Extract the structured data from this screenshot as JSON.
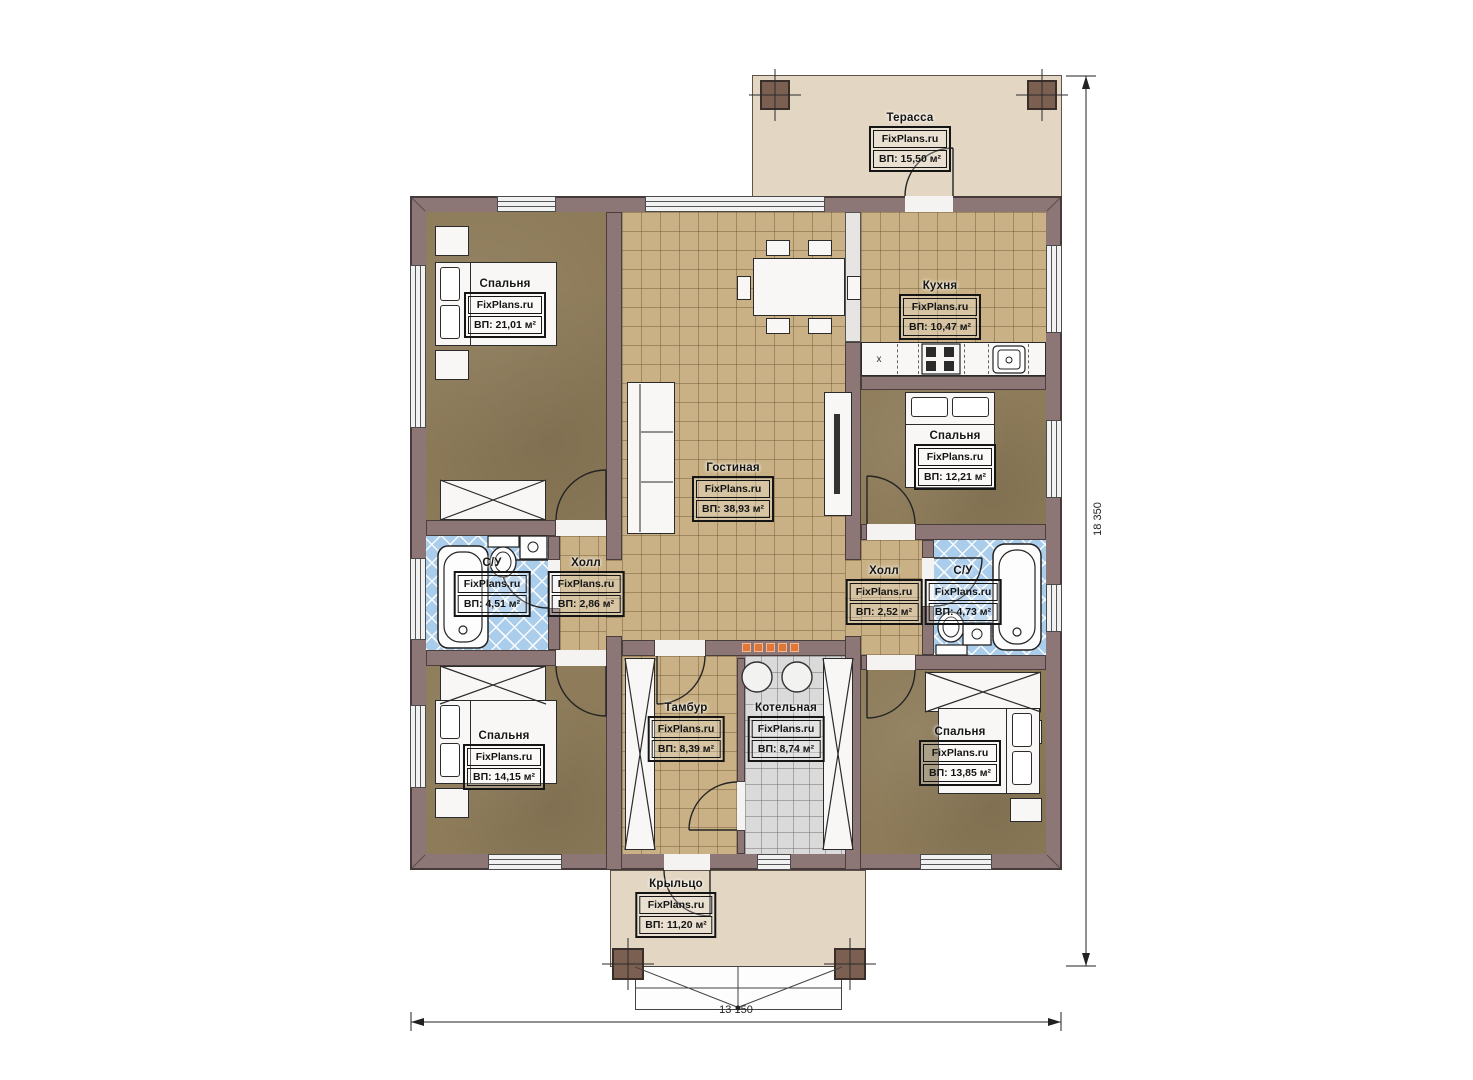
{
  "plan": {
    "brand": "FixPlans.ru",
    "dimension_width": "13 150",
    "dimension_height": "18 350",
    "fridge_marker": "x"
  },
  "rooms": {
    "terrace": {
      "name": "Терасса",
      "brand": "FixPlans.ru",
      "area": "ВП: 15,50 м²"
    },
    "bedroom_tl": {
      "name": "Спальня",
      "brand": "FixPlans.ru",
      "area": "ВП: 21,01 м²"
    },
    "kitchen": {
      "name": "Кухня",
      "brand": "FixPlans.ru",
      "area": "ВП: 10,47 м²"
    },
    "living": {
      "name": "Гостиная",
      "brand": "FixPlans.ru",
      "area": "ВП: 38,93 м²"
    },
    "bedroom_right": {
      "name": "Спальня",
      "brand": "FixPlans.ru",
      "area": "ВП: 12,21 м²"
    },
    "bath_left": {
      "name": "С/У",
      "brand": "FixPlans.ru",
      "area": "ВП: 4,51 м²"
    },
    "hall_left": {
      "name": "Холл",
      "brand": "FixPlans.ru",
      "area": "ВП: 2,86 м²"
    },
    "hall_right": {
      "name": "Холл",
      "brand": "FixPlans.ru",
      "area": "ВП: 2,52 м²"
    },
    "bath_right": {
      "name": "С/У",
      "brand": "FixPlans.ru",
      "area": "ВП: 4,73 м²"
    },
    "bedroom_bl": {
      "name": "Спальня",
      "brand": "FixPlans.ru",
      "area": "ВП: 14,15 м²"
    },
    "tambour": {
      "name": "Тамбур",
      "brand": "FixPlans.ru",
      "area": "ВП: 8,39 м²"
    },
    "boiler": {
      "name": "Котельная",
      "brand": "FixPlans.ru",
      "area": "ВП: 8,74 м²"
    },
    "bedroom_br": {
      "name": "Спальня",
      "brand": "FixPlans.ru",
      "area": "ВП: 13,85 м²"
    },
    "porch": {
      "name": "Крыльцо",
      "brand": "FixPlans.ru",
      "area": "ВП: 11,20 м²"
    }
  },
  "colors": {
    "wall": "#8c7676",
    "wall_edge": "#463a3a",
    "wood": "#8d7b59",
    "tile_tan": "#c9b185",
    "tile_blue": "#abcdec",
    "tile_gray": "#dadada",
    "deck": "#e3d6c2",
    "furniture": "#f8f7f5",
    "radiator": "#e0763a"
  }
}
